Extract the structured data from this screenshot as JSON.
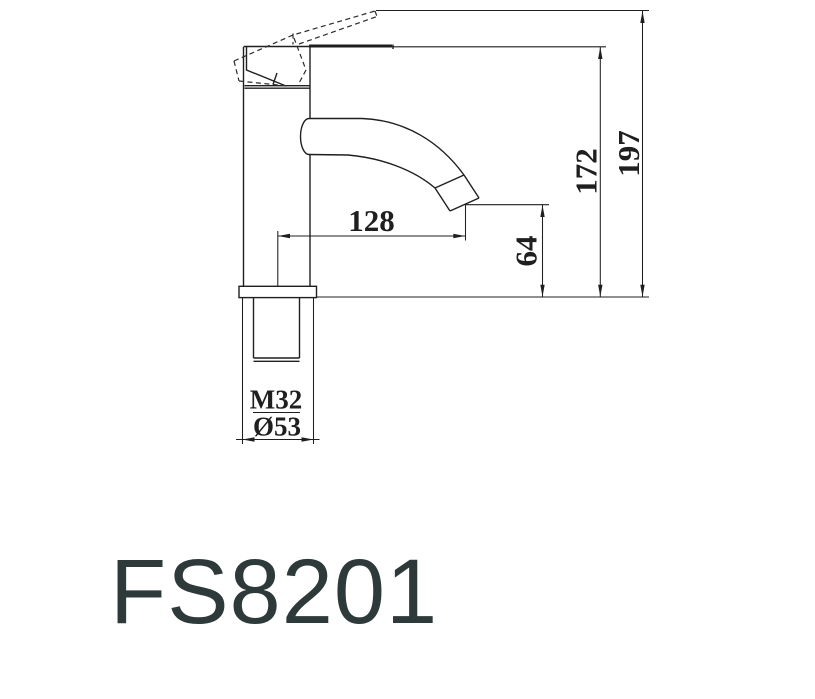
{
  "drawing": {
    "type": "faucet-technical-drawing",
    "model": "FS8201",
    "dimensions": {
      "spout_reach": "128",
      "outlet_height": "64",
      "body_height": "172",
      "total_height": "197",
      "thread_size": "M32",
      "base_diameter": "Ø53"
    },
    "colors": {
      "line": "#1f1f1f",
      "model_text": "#2e3a3a",
      "background": "#ffffff"
    }
  }
}
